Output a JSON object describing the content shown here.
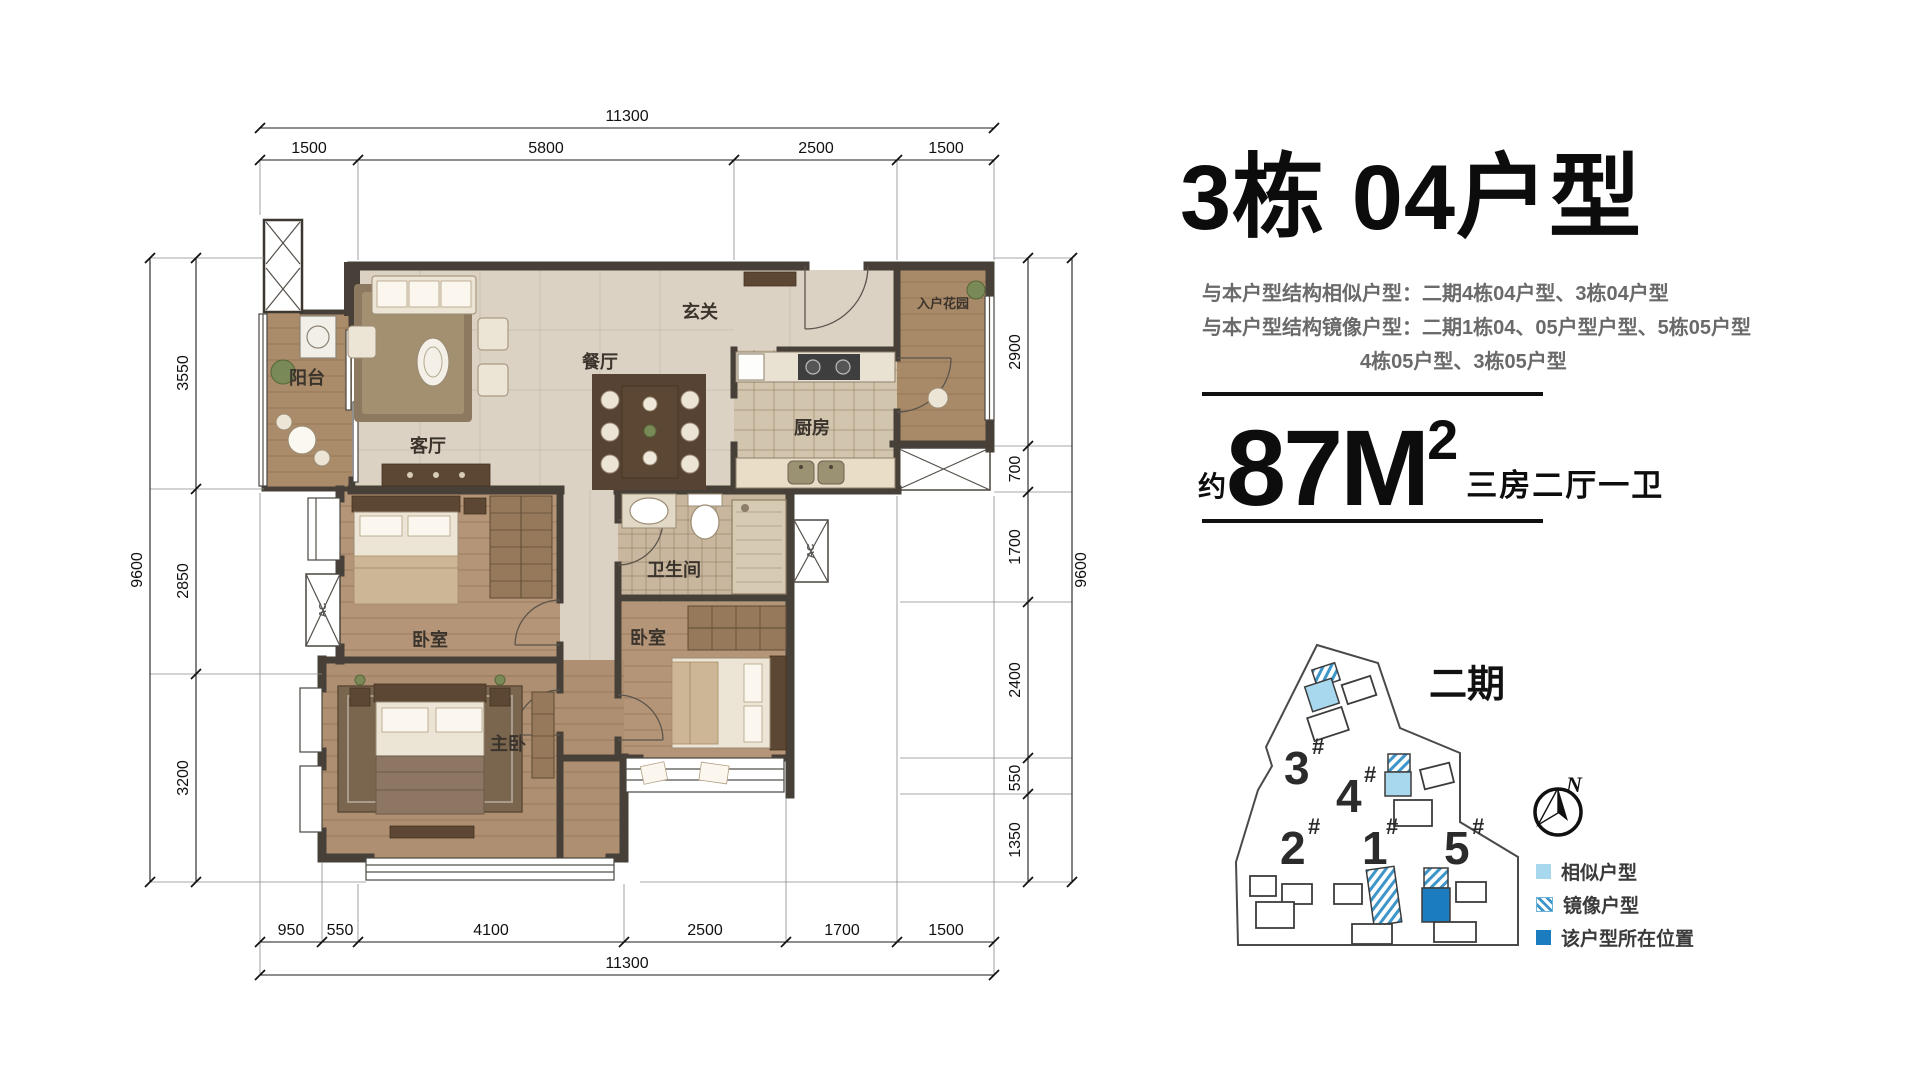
{
  "plan": {
    "rooms": [
      {
        "label": "阳台"
      },
      {
        "label": "客厅"
      },
      {
        "label": "餐厅"
      },
      {
        "label": "玄关"
      },
      {
        "label": "入户花园"
      },
      {
        "label": "厨房"
      },
      {
        "label": "卫生间"
      },
      {
        "label": "卧室"
      },
      {
        "label": "卧室"
      },
      {
        "label": "主卧"
      }
    ],
    "ac_label": "AC",
    "dims": {
      "top": {
        "overall": "11300",
        "s0": "1500",
        "s1": "5800",
        "s2": "2500",
        "s3": "1500"
      },
      "bottom": {
        "overall": "11300",
        "s0": "950",
        "s1": "550",
        "s2": "4100",
        "s3": "2500",
        "s4": "1700",
        "s5": "1500"
      },
      "left": {
        "overall": "9600",
        "s0": "3550",
        "s1": "2850",
        "s2": "3200"
      },
      "right": {
        "overall": "9600",
        "s0": "2900",
        "s1": "700",
        "s2": "1700",
        "s3": "2400",
        "s4": "550",
        "s5": "1350"
      }
    }
  },
  "panel": {
    "title": "3栋 04户型",
    "line_similar": "与本户型结构相似户型：二期4栋04户型、3栋04户型",
    "line_mirror": "与本户型结构镜像户型：二期1栋04、05户型户型、5栋05户型",
    "line_mirror2": "4栋05户型、3栋05户型",
    "area_prefix": "约",
    "area_value": "87M",
    "area_sup": "2",
    "area_desc": "三房二厅一卫"
  },
  "site": {
    "phase": "二期",
    "compass": "N",
    "buildings": [
      {
        "num": "3",
        "sup": "#"
      },
      {
        "num": "4",
        "sup": "#"
      },
      {
        "num": "2",
        "sup": "#"
      },
      {
        "num": "1",
        "sup": "#"
      },
      {
        "num": "5",
        "sup": "#"
      }
    ],
    "legend": [
      {
        "label": "相似户型",
        "swatch": "#a8d8ee"
      },
      {
        "label": "镜像户型",
        "swatch": "striped"
      },
      {
        "label": "该户型所在位置",
        "swatch": "#1b7cc0"
      }
    ]
  }
}
